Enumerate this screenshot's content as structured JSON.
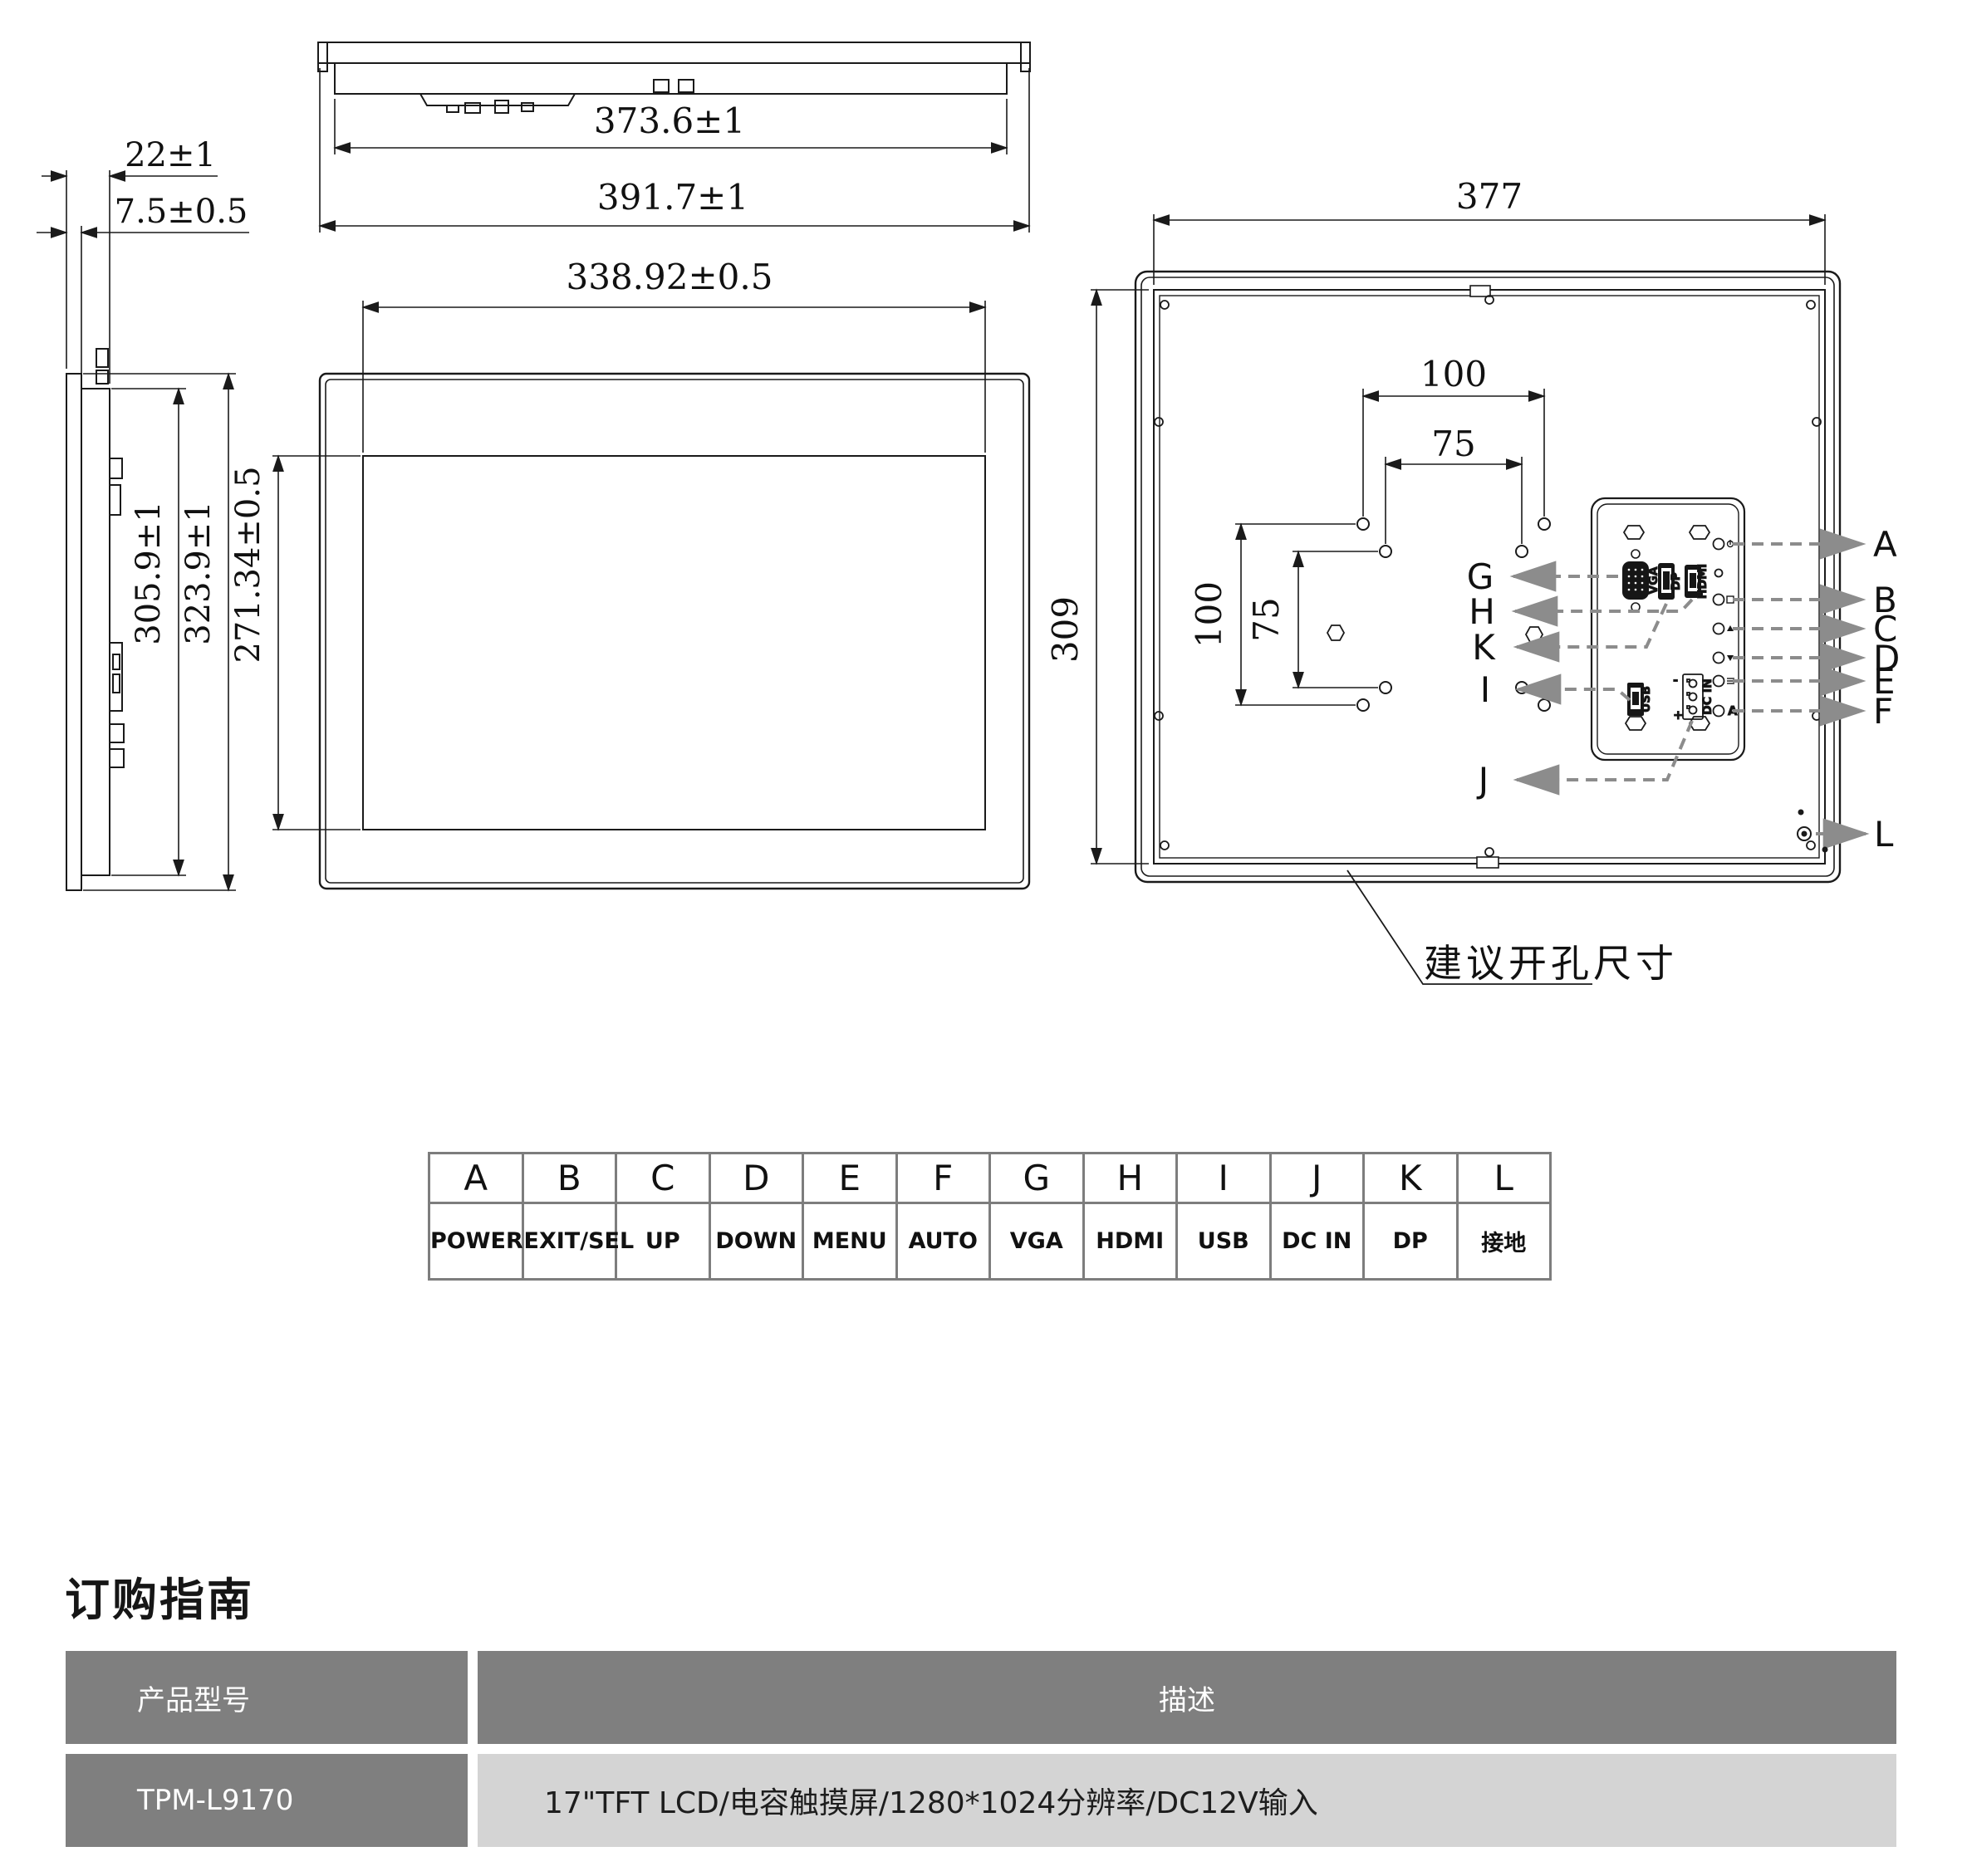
{
  "dims": {
    "depth_total": "22±1",
    "depth_front": "7.5±0.5",
    "h_body": "305.9±1",
    "h_total": "323.9±1",
    "h_active": "271.34±0.5",
    "w_body": "373.6±1",
    "w_total": "391.7±1",
    "w_active": "338.92±0.5",
    "rear_w": "377",
    "rear_h": "309",
    "vesa100": "100",
    "vesa75": "75",
    "cutout_note": "建议开孔尺寸"
  },
  "ports": {
    "vga": "VGA",
    "dp": "DP",
    "hdmi": "HDMI",
    "usb": "USB",
    "dcin": "DC IN",
    "plus": "+",
    "minus": "-"
  },
  "callouts": {
    "a": "A",
    "b": "B",
    "c": "C",
    "d": "D",
    "e": "E",
    "f": "F",
    "g": "G",
    "h": "H",
    "i": "I",
    "j": "J",
    "k": "K",
    "l": "L"
  },
  "legend": {
    "letters": [
      "A",
      "B",
      "C",
      "D",
      "E",
      "F",
      "G",
      "H",
      "I",
      "J",
      "K",
      "L"
    ],
    "functions": [
      "POWER",
      "EXIT/SEL",
      "UP",
      "DOWN",
      "MENU",
      "AUTO",
      "VGA",
      "HDMI",
      "USB",
      "DC IN",
      "DP",
      "接地"
    ]
  },
  "order_guide": {
    "title": "订购指南",
    "col_model": "产品型号",
    "col_desc": "描述",
    "model": "TPM-L9170",
    "description": "17\"TFT LCD/电容触摸屏/1280*1024分辨率/DC12V输入"
  }
}
